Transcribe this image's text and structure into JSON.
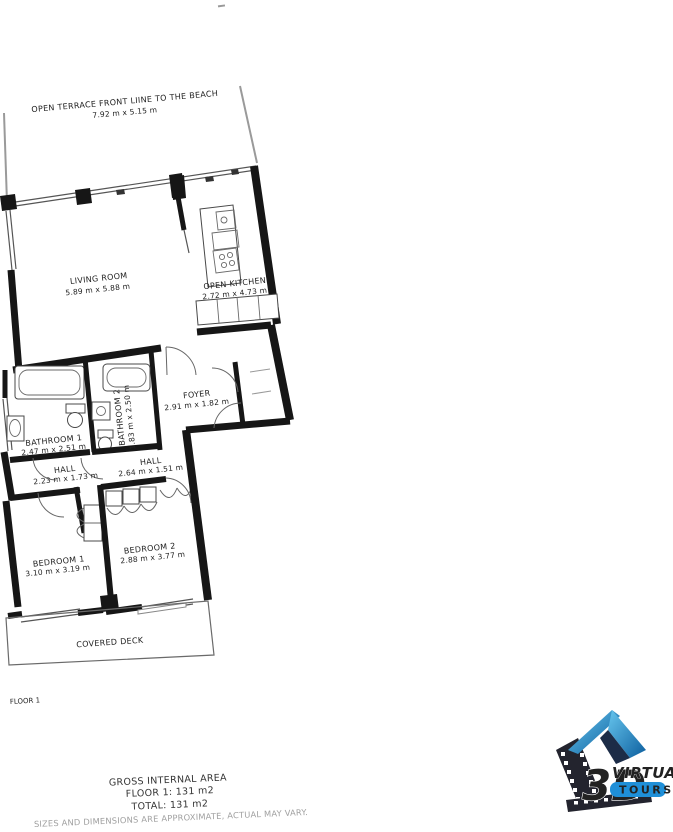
{
  "floorplan": {
    "terrace": {
      "name": "OPEN TERRACE FRONT LIINE TO THE BEACH",
      "dims": "7.92 m x 5.15 m"
    },
    "living_room": {
      "name": "LIVING ROOM",
      "dims": "5.89 m x 5.88 m"
    },
    "open_kitchen": {
      "name": "OPEN KITCHEN",
      "dims": "2.72 m x 4.73 m"
    },
    "foyer": {
      "name": "FOYER",
      "dims": "2.91 m x 1.82 m"
    },
    "bathroom_1": {
      "name": "BATHROOM 1",
      "dims": "2.47 m x 2.51 m"
    },
    "bathroom_2": {
      "name": "BATHROOM 2",
      "dims": "1.83 m x 2.50 m"
    },
    "hall_1": {
      "name": "HALL",
      "dims": "2.23 m x 1.73 m"
    },
    "hall_2": {
      "name": "HALL",
      "dims": "2.64 m x 1.51 m"
    },
    "bedroom_1": {
      "name": "BEDROOM 1",
      "dims": "3.10 m x 3.19 m"
    },
    "bedroom_2": {
      "name": "BEDROOM 2",
      "dims": "2.88 m x 3.77 m"
    },
    "covered_deck": {
      "name": "COVERED DECK"
    },
    "floor_label": "FLOOR 1"
  },
  "summary": {
    "title": "GROSS INTERNAL AREA",
    "floor_line": "FLOOR 1: 131 m2",
    "total_line": "TOTAL: 131 m2",
    "disclaimer": "SIZES AND DIMENSIONS ARE APPROXIMATE, ACTUAL MAY VARY."
  },
  "logo": {
    "text_3d": "3D",
    "text_virtual": "VIRTUAL",
    "text_tours": "TOURS",
    "accent_blue": "#1f8fd8",
    "dark_navy": "#1c2c47",
    "strip_dark": "#23242e"
  }
}
